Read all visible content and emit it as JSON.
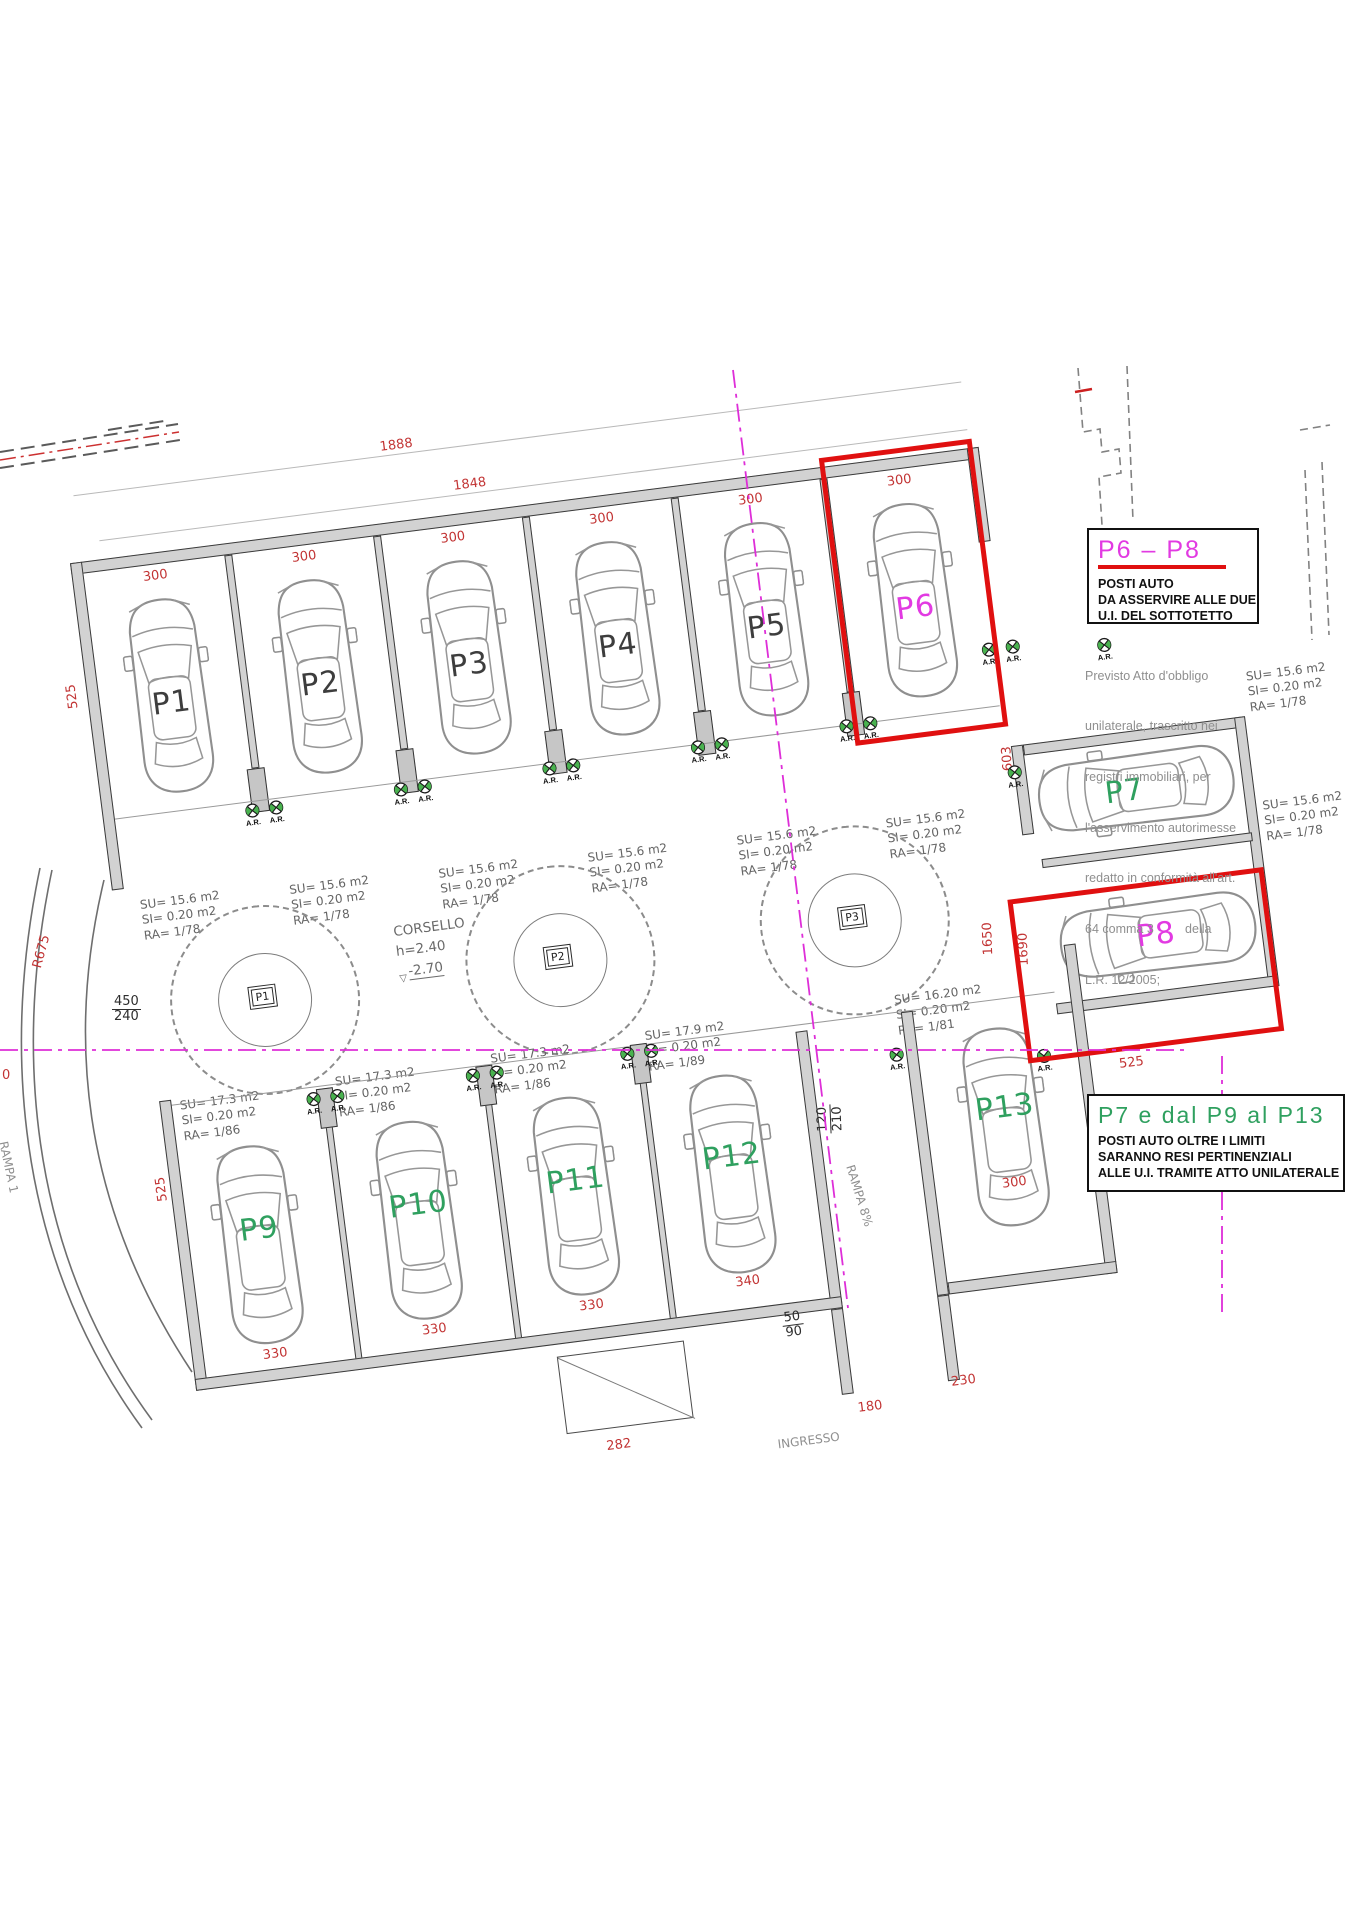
{
  "boxes": {
    "p6p8": {
      "title": "P6 – P8",
      "line1": "POSTI AUTO",
      "line2": "DA ASSERVIRE ALLE DUE",
      "line3": "U.I. DEL SOTTOTETTO"
    },
    "p7p9p13": {
      "title": "P7 e dal P9 al P13",
      "line1": "POSTI AUTO OLTRE I LIMITI",
      "line2": "SARANNO RESI PERTINENZIALI",
      "line3": "ALLE U.I. TRAMITE ATTO UNILATERALE"
    },
    "note_lines": [
      "Previsto Atto d'obbligo",
      "unilaterale, trascritto nei",
      "registri immobiliari, per",
      "l'asservimento autorimesse",
      "redatto in conformità all'art.",
      "64 comma 3         della",
      "L.R. 12/2005;"
    ]
  },
  "corsello": {
    "name": "CORSELLO",
    "h": "h=2.40",
    "q": "-2.70"
  },
  "stalls": {
    "p1": {
      "label": "P1",
      "su": "SU= 15.6 m2",
      "si": "SI= 0.20 m2",
      "ra": "RA= 1/78",
      "dim": "300"
    },
    "p2": {
      "label": "P2",
      "su": "SU= 15.6 m2",
      "si": "SI= 0.20 m2",
      "ra": "RA= 1/78",
      "dim": "300"
    },
    "p3": {
      "label": "P3",
      "su": "SU= 15.6 m2",
      "si": "SI= 0.20 m2",
      "ra": "RA= 1/78",
      "dim": "300"
    },
    "p4": {
      "label": "P4",
      "su": "SU= 15.6 m2",
      "si": "SI= 0.20 m2",
      "ra": "RA= 1/78",
      "dim": "300"
    },
    "p5": {
      "label": "P5",
      "su": "SU= 15.6 m2",
      "si": "SI= 0.20 m2",
      "ra": "RA= 1/78",
      "dim": "300"
    },
    "p6": {
      "label": "P6",
      "su": "SU= 15.6 m2",
      "si": "SI= 0.20 m2",
      "ra": "RA= 1/78",
      "dim": "300"
    },
    "p7": {
      "label": "P7",
      "su": "SU= 15.6 m2",
      "si": "SI= 0.20 m2",
      "ra": "RA= 1/78"
    },
    "p8": {
      "label": "P8",
      "su": "SU= 15.6 m2",
      "si": "SI= 0.20 m2",
      "ra": "RA= 1/78"
    },
    "p9": {
      "label": "P9",
      "su": "SU= 17.3 m2",
      "si": "SI= 0.20 m2",
      "ra": "RA= 1/86",
      "dim": "330"
    },
    "p10": {
      "label": "P10",
      "su": "SU= 17.3 m2",
      "si": "SI= 0.20 m2",
      "ra": "RA= 1/86",
      "dim": "330"
    },
    "p11": {
      "label": "P11",
      "su": "SU= 17.3 m2",
      "si": "SI= 0.20 m2",
      "ra": "RA= 1/86",
      "dim": "330"
    },
    "p12": {
      "label": "P12",
      "su": "SU= 17.9 m2",
      "si": "SI= 0.20 m2",
      "ra": "RA= 1/89",
      "dim": "340"
    },
    "p13": {
      "label": "P13",
      "su": "SU= 16.20 m2",
      "si": "SI= 0.20 m2",
      "ra": "RA= 1/81",
      "dim": "300"
    }
  },
  "pillars": {
    "p1": "P1",
    "p2": "P2",
    "p3": "P3"
  },
  "dims": {
    "d1888": "1888",
    "d1848": "1848",
    "d525a": "525",
    "d525b": "525",
    "d525c": "525",
    "d603": "603",
    "d1650": "1650",
    "d1690": "1690",
    "f450": "450",
    "f240": "240",
    "f120": "120",
    "f210": "210",
    "f50": "50",
    "f90": "90",
    "d282": "282",
    "d230": "230",
    "d180": "180",
    "r675": "R675",
    "d0": "0"
  },
  "labels": {
    "rampa8": "RAMPA 8%",
    "rampa1": "RAMPA 1",
    "ingresso": "INGRESSO",
    "ar": "A.R."
  },
  "colors": {
    "highlight_red": "#e01010",
    "dim_red": "#c23434",
    "magenta": "#e23ae2",
    "green": "#2fa05f",
    "section_magenta": "#de2ed8",
    "wall_gray": "#d2d2d2"
  }
}
